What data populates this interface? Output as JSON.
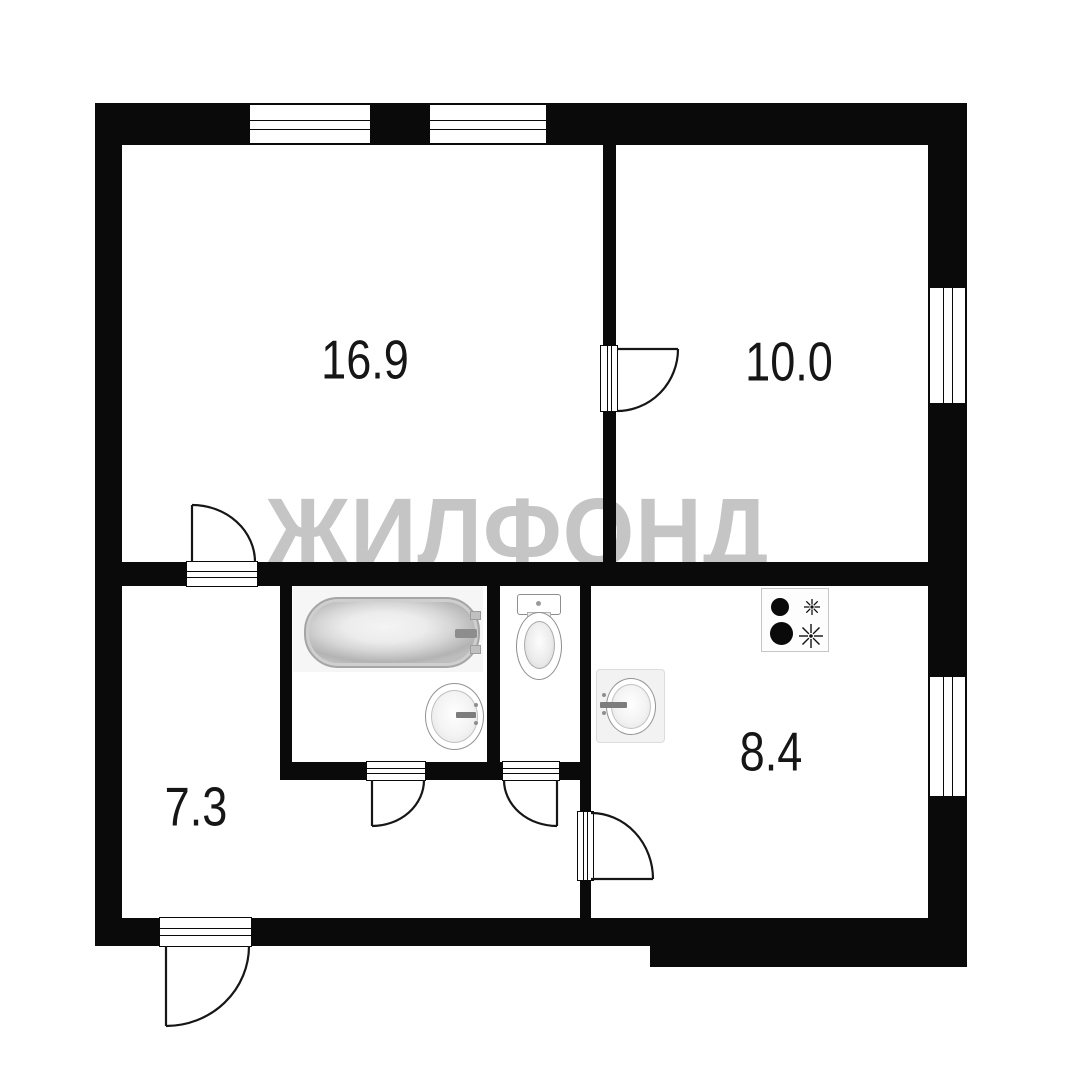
{
  "floorplan": {
    "watermark_text": "ЖИЛФОНД",
    "rooms": [
      {
        "id": "room-top-left",
        "area": "16.9"
      },
      {
        "id": "room-top-right",
        "area": "10.0"
      },
      {
        "id": "room-bottom-left",
        "area": "7.3"
      },
      {
        "id": "kitchen",
        "area": "8.4"
      }
    ],
    "fixtures": [
      "bathtub",
      "bathroom-sink",
      "toilet",
      "kitchen-sink",
      "stove-4-burner"
    ],
    "features": [
      "2 top windows",
      "2 right windows",
      "6 door swings",
      "entrance door bottom-left"
    ],
    "colors": {
      "wall": "#0a0a0a",
      "floor": "#ffffff",
      "watermark": "#c5c5c5",
      "fixture_outline": "#8e8e8e"
    }
  }
}
